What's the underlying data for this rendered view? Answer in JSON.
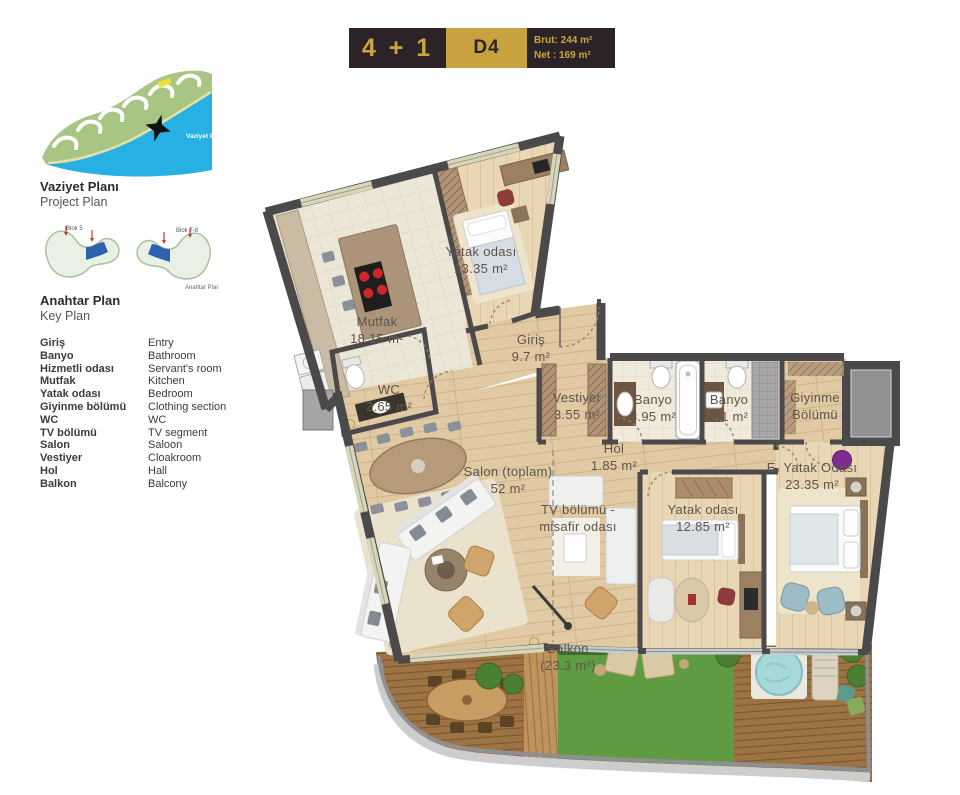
{
  "header": {
    "unit_type": "4 + 1",
    "unit_code": "D4",
    "brut": "Brut: 244 m²",
    "net": "Net : 169 m²"
  },
  "sidebar": {
    "project_plan": {
      "title": "Vaziyet Planı",
      "subtitle": "Project Plan",
      "map_label": "Vaziyet Planı"
    },
    "key_plan": {
      "title": "Anahtar Plan",
      "subtitle": "Key Plan",
      "map_label": "Anahtar Planı",
      "blok_left": "Blok 5",
      "blok_right": "Blok 7-8"
    },
    "legend": [
      {
        "tr": "Giriş",
        "en": "Entry"
      },
      {
        "tr": "Banyo",
        "en": "Bathroom"
      },
      {
        "tr": "Hizmetli odası",
        "en": "Servant's room"
      },
      {
        "tr": "Mutfak",
        "en": "Kitchen"
      },
      {
        "tr": "Yatak odası",
        "en": "Bedroom"
      },
      {
        "tr": "Giyinme bölümü",
        "en": "Clothing section"
      },
      {
        "tr": "WC",
        "en": "WC"
      },
      {
        "tr": "TV bölümü",
        "en": "TV segment"
      },
      {
        "tr": "Salon",
        "en": "Saloon"
      },
      {
        "tr": "Vestiyer",
        "en": "Cloakroom"
      },
      {
        "tr": "Hol",
        "en": "Hall"
      },
      {
        "tr": "Balkon",
        "en": "Balcony"
      }
    ]
  },
  "plan": {
    "rooms": [
      {
        "id": "yatak-odasi-1",
        "line1": "Yatak odası",
        "line2": "13.35 m²",
        "x": 481,
        "y": 256
      },
      {
        "id": "mutfak",
        "line1": "Mutfak",
        "line2": "18.15 m²",
        "x": 377,
        "y": 326
      },
      {
        "id": "giris",
        "line1": "Giriş",
        "line2": "9.7 m²",
        "x": 531,
        "y": 344
      },
      {
        "id": "wc",
        "line1": "WC",
        "line2": "2.65 m²",
        "x": 389,
        "y": 394
      },
      {
        "id": "vestiyer",
        "line1": "Vestiyer",
        "line2": "3.55 m²",
        "x": 577,
        "y": 402
      },
      {
        "id": "banyo-1",
        "line1": "Banyo",
        "line2": "3.95 m²",
        "x": 653,
        "y": 404
      },
      {
        "id": "banyo-2",
        "line1": "Banyo",
        "line2": "4.1 m²",
        "x": 729,
        "y": 404
      },
      {
        "id": "giyinme-bolumu",
        "line1": "Giyinme",
        "line2": "Bölümü",
        "x": 815,
        "y": 402
      },
      {
        "id": "hol",
        "line1": "Hol",
        "line2": "1.85 m²",
        "x": 614,
        "y": 453
      },
      {
        "id": "salon",
        "line1": "Salon (toplam)",
        "line2": "52 m²",
        "x": 508,
        "y": 476
      },
      {
        "id": "tv-bolumu",
        "line1": "TV bölümü -",
        "line2": "misafir odası",
        "x": 578,
        "y": 514
      },
      {
        "id": "yatak-odasi-2",
        "line1": "Yatak odası",
        "line2": "12.85 m²",
        "x": 703,
        "y": 514
      },
      {
        "id": "e-yatak-odasi",
        "line1": "E. Yatak Odası",
        "line2": "23.35 m²",
        "x": 812,
        "y": 472
      },
      {
        "id": "balkon",
        "line1": "Balkon",
        "line2": "(23.3 m²)",
        "x": 568,
        "y": 653,
        "color": "#eef3e9"
      }
    ]
  },
  "colors": {
    "gold": "#c8a23f",
    "header_dark": "#2b2327",
    "wall": "#4b4949",
    "wood": "#e0c9a3",
    "grass": "#5f9c41",
    "water": "#26b0e3",
    "key_highlight": "#2e62b1",
    "purple_accent": "#7e2b93"
  }
}
